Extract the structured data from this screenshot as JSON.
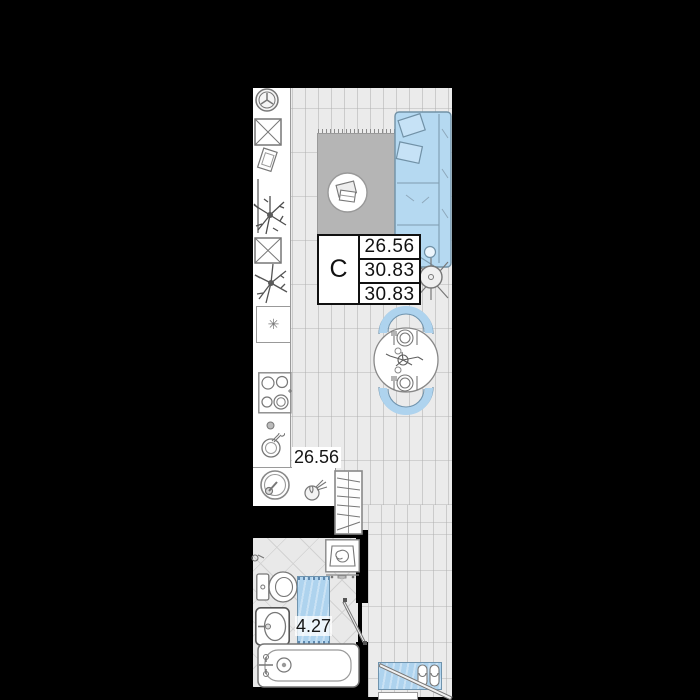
{
  "unit_card": {
    "type_label": "С",
    "area_rows": [
      "26.56",
      "30.83",
      "30.83"
    ]
  },
  "floor_labels": {
    "main_area": "26.56",
    "bathroom_mat_area": "4.27"
  },
  "colors": {
    "background": "#000000",
    "wood_floor": "#ebebeb",
    "plank_line": "#cbcbcb",
    "tile_floor": "#e9e9e9",
    "tile_line": "#d2d2d2",
    "accent_blue": "#aed3ee",
    "blue_outline": "#6f93ad",
    "rug_gray": "#b5b5b5",
    "outline_gray": "#888888",
    "label_text": "#111111",
    "label_background": "#ffffff"
  },
  "icons": {
    "kitchen": [
      "cooker-hood-icon",
      "cabinet-cross-icon",
      "cutting-board-icon",
      "utensil-rail-icon",
      "plant-icon",
      "cabinet-cross-icon",
      "plant-icon",
      "lamp-box-icon",
      "stove-icon",
      "knob-icon",
      "mixing-bowl-icon",
      "kitchen-sink-icon",
      "garlic-icon",
      "drying-rack-icon"
    ],
    "living": [
      "rug",
      "coffee-table",
      "sofa",
      "floor-lamp-icon",
      "dining-table",
      "chair",
      "place-setting-icon"
    ],
    "bathroom": [
      "washing-machine",
      "paper-holder-icon",
      "toilet",
      "vanity-sink",
      "bath-mat",
      "bathtub",
      "door-leaf"
    ],
    "hallway": [
      "entry-mat",
      "slippers-icon",
      "entry-door-leaf",
      "threshold"
    ]
  }
}
